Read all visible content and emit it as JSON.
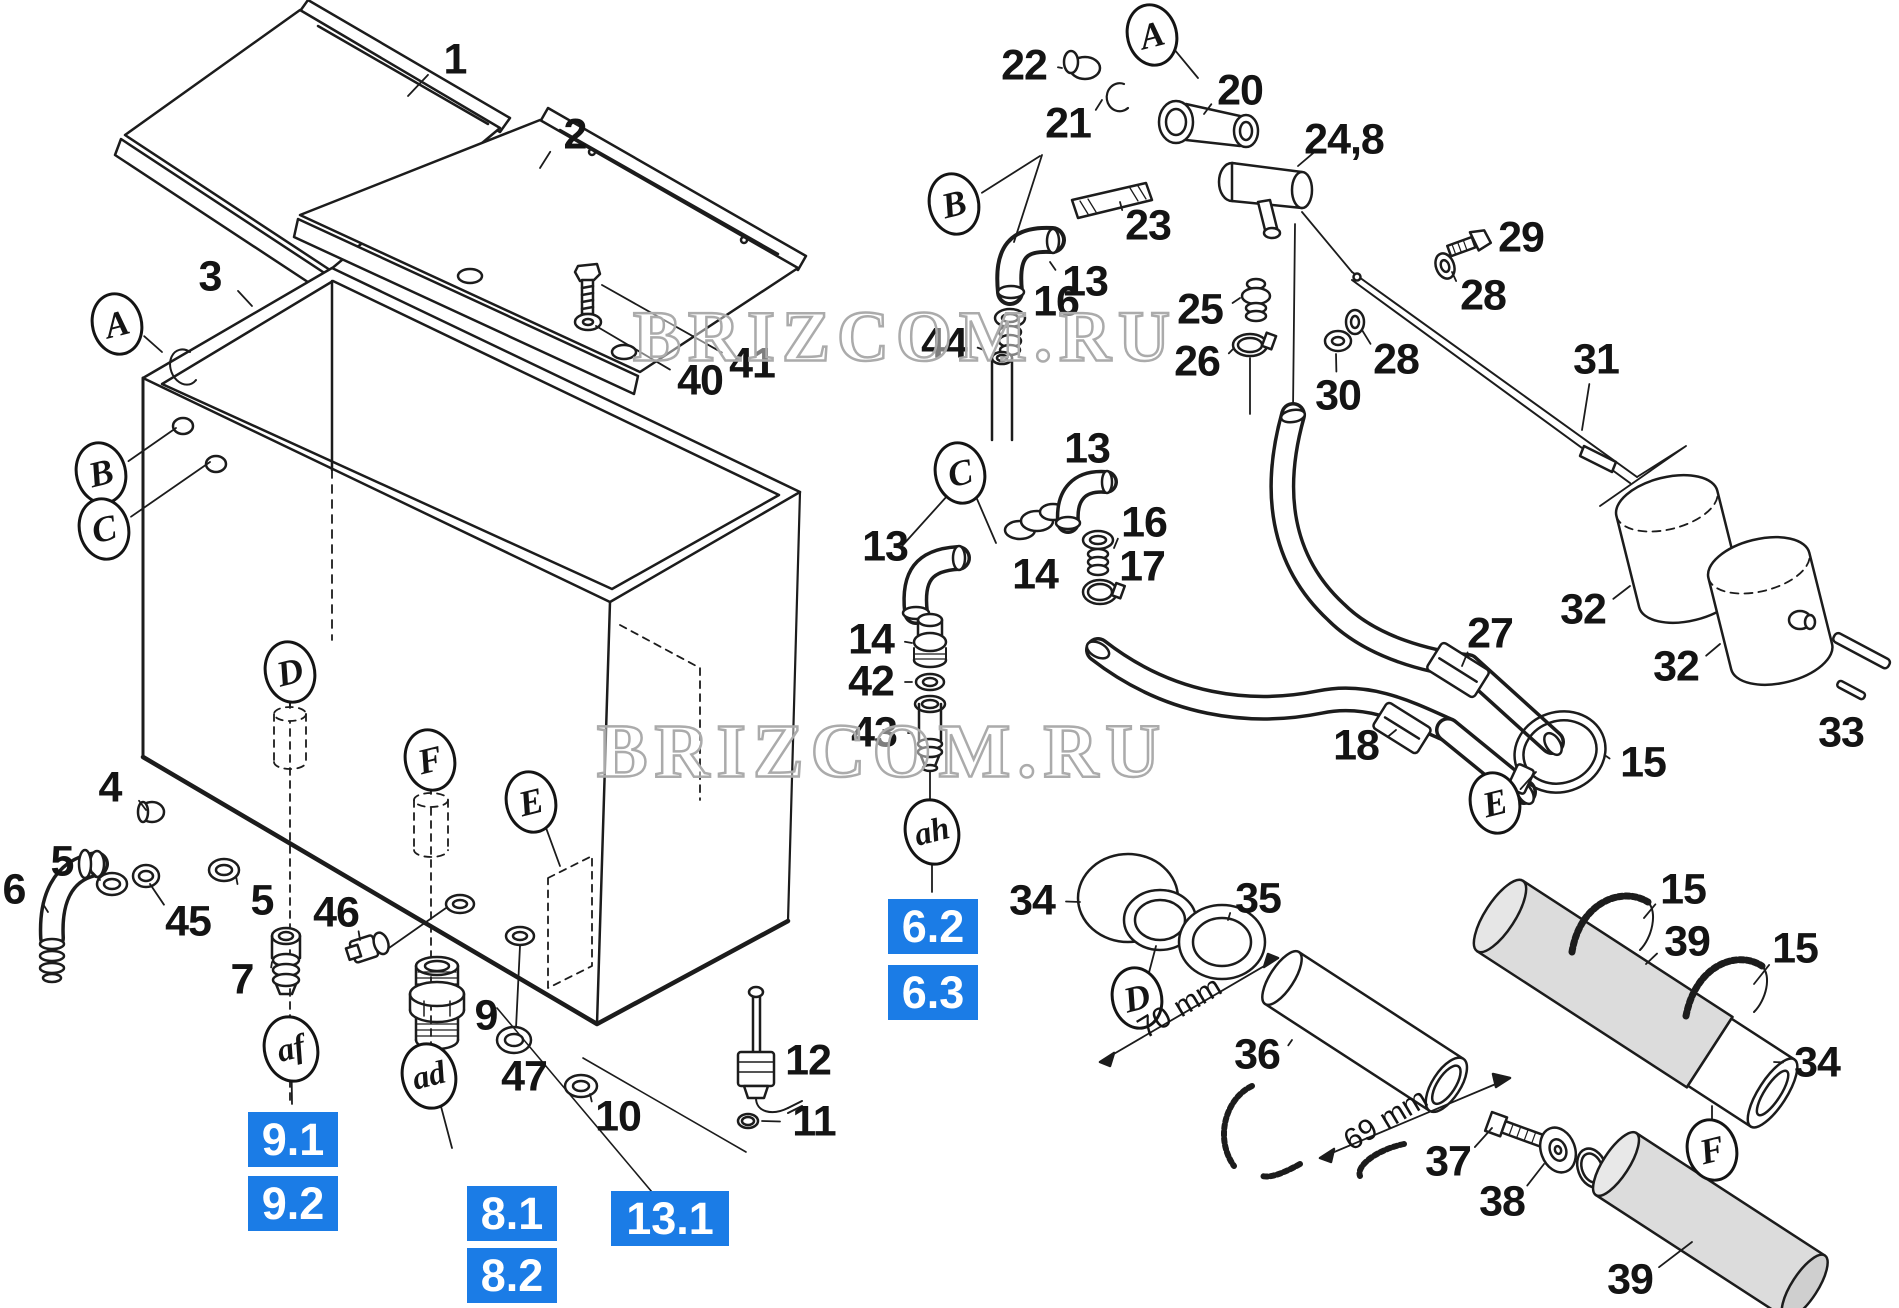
{
  "diagram": {
    "page_background": "#ffffff",
    "line_color": "#1c1c1c",
    "accent_blue": "#1b7ce6",
    "watermark_color": "#ababab",
    "watermarks": [
      {
        "text": "BRIZCOM.RU",
        "x": 905,
        "y": 337,
        "size": 72
      },
      {
        "text": "BRIZCOM.RU",
        "x": 882,
        "y": 752,
        "size": 76
      }
    ],
    "part_labels": [
      {
        "t": "1",
        "x": 455,
        "y": 60,
        "lx": 408,
        "ly": 96
      },
      {
        "t": "2",
        "x": 575,
        "y": 135,
        "lx": 540,
        "ly": 168
      },
      {
        "t": "3",
        "x": 210,
        "y": 277,
        "lx": 252,
        "ly": 306
      },
      {
        "t": "40",
        "x": 700,
        "y": 381,
        "lx": 596,
        "ly": 326
      },
      {
        "t": "41",
        "x": 752,
        "y": 364,
        "lx": 602,
        "ly": 285
      },
      {
        "t": "4",
        "x": 110,
        "y": 788,
        "lx": 146,
        "ly": 810
      },
      {
        "t": "5",
        "x": 62,
        "y": 862,
        "lx": 100,
        "ly": 880
      },
      {
        "t": "6",
        "x": 14,
        "y": 890,
        "lx": 48,
        "ly": 912
      },
      {
        "t": "45",
        "x": 188,
        "y": 922,
        "lx": 150,
        "ly": 884
      },
      {
        "t": "5",
        "x": 262,
        "y": 901,
        "lx": 236,
        "ly": 876
      },
      {
        "t": "46",
        "x": 336,
        "y": 913,
        "lx": 360,
        "ly": 940
      },
      {
        "t": "7",
        "x": 242,
        "y": 980,
        "lx": 272,
        "ly": 962
      },
      {
        "t": "9",
        "x": 486,
        "y": 1016,
        "lx": 460,
        "ly": 1002
      },
      {
        "t": "47",
        "x": 524,
        "y": 1077,
        "lx": 514,
        "ly": 1050
      },
      {
        "t": "10",
        "x": 618,
        "y": 1117,
        "lx": 590,
        "ly": 1094
      },
      {
        "t": "12",
        "x": 808,
        "y": 1061,
        "lx": 778,
        "ly": 1064
      },
      {
        "t": "11",
        "x": 814,
        "y": 1122,
        "lx": 762,
        "ly": 1121
      },
      {
        "t": "22",
        "x": 1024,
        "y": 66,
        "lx": 1062,
        "ly": 68
      },
      {
        "t": "21",
        "x": 1068,
        "y": 124,
        "lx": 1102,
        "ly": 100
      },
      {
        "t": "20",
        "x": 1240,
        "y": 91,
        "lx": 1204,
        "ly": 114
      },
      {
        "t": "23",
        "x": 1148,
        "y": 226,
        "lx": 1120,
        "ly": 202
      },
      {
        "t": "24,8",
        "x": 1344,
        "y": 140,
        "lx": 1298,
        "ly": 166
      },
      {
        "t": "13",
        "x": 1085,
        "y": 282,
        "lx": 1050,
        "ly": 262
      },
      {
        "t": "16",
        "x": 1056,
        "y": 302,
        "lx": 1028,
        "ly": 318
      },
      {
        "t": "44",
        "x": 944,
        "y": 344,
        "lx": 984,
        "ly": 350
      },
      {
        "t": "25",
        "x": 1200,
        "y": 310,
        "lx": 1240,
        "ly": 298
      },
      {
        "t": "26",
        "x": 1197,
        "y": 362,
        "lx": 1234,
        "ly": 348
      },
      {
        "t": "29",
        "x": 1521,
        "y": 238,
        "lx": 1490,
        "ly": 242
      },
      {
        "t": "28",
        "x": 1483,
        "y": 296,
        "lx": 1452,
        "ly": 272
      },
      {
        "t": "28",
        "x": 1396,
        "y": 360,
        "lx": 1362,
        "ly": 330
      },
      {
        "t": "30",
        "x": 1338,
        "y": 396,
        "lx": 1336,
        "ly": 354
      },
      {
        "t": "31",
        "x": 1596,
        "y": 360,
        "lx": 1582,
        "ly": 430
      },
      {
        "t": "13",
        "x": 885,
        "y": 547,
        "lx": 912,
        "ly": 566
      },
      {
        "t": "13",
        "x": 1087,
        "y": 449,
        "lx": 1082,
        "ly": 480
      },
      {
        "t": "14",
        "x": 1035,
        "y": 575,
        "lx": 1036,
        "ly": 544
      },
      {
        "t": "16",
        "x": 1144,
        "y": 523,
        "lx": 1114,
        "ly": 548
      },
      {
        "t": "17",
        "x": 1142,
        "y": 567,
        "lx": 1118,
        "ly": 590
      },
      {
        "t": "14",
        "x": 871,
        "y": 640,
        "lx": 912,
        "ly": 643
      },
      {
        "t": "42",
        "x": 871,
        "y": 682,
        "lx": 912,
        "ly": 682
      },
      {
        "t": "43",
        "x": 874,
        "y": 733,
        "lx": 912,
        "ly": 733
      },
      {
        "t": "27",
        "x": 1490,
        "y": 634,
        "lx": 1462,
        "ly": 666
      },
      {
        "t": "18",
        "x": 1356,
        "y": 746,
        "lx": 1396,
        "ly": 730
      },
      {
        "t": "32",
        "x": 1583,
        "y": 610,
        "lx": 1630,
        "ly": 586
      },
      {
        "t": "32",
        "x": 1676,
        "y": 667,
        "lx": 1720,
        "ly": 644
      },
      {
        "t": "33",
        "x": 1841,
        "y": 733,
        "lx": 1851,
        "ly": 702
      },
      {
        "t": "15",
        "x": 1643,
        "y": 763,
        "lx": 1606,
        "ly": 756
      },
      {
        "t": "34",
        "x": 1032,
        "y": 901,
        "lx": 1080,
        "ly": 902
      },
      {
        "t": "35",
        "x": 1258,
        "y": 899,
        "lx": 1228,
        "ly": 920
      },
      {
        "t": "36",
        "x": 1257,
        "y": 1055,
        "lx": 1292,
        "ly": 1040
      },
      {
        "t": "37",
        "x": 1448,
        "y": 1162,
        "lx": 1492,
        "ly": 1128
      },
      {
        "t": "38",
        "x": 1502,
        "y": 1202,
        "lx": 1544,
        "ly": 1164
      },
      {
        "t": "15",
        "x": 1683,
        "y": 890,
        "lx": 1644,
        "ly": 918
      },
      {
        "t": "39",
        "x": 1687,
        "y": 942,
        "lx": 1646,
        "ly": 964
      },
      {
        "t": "15",
        "x": 1795,
        "y": 949,
        "lx": 1754,
        "ly": 984
      },
      {
        "t": "34",
        "x": 1817,
        "y": 1063,
        "lx": 1774,
        "ly": 1062
      },
      {
        "t": "39",
        "x": 1630,
        "y": 1280,
        "lx": 1692,
        "ly": 1242
      }
    ],
    "callouts": [
      {
        "t": "A",
        "x": 117,
        "y": 324,
        "lx": 162,
        "ly": 352
      },
      {
        "t": "B",
        "x": 101,
        "y": 473,
        "lx": 176,
        "ly": 428
      },
      {
        "t": "C",
        "x": 104,
        "y": 529,
        "lx": 210,
        "ly": 462
      },
      {
        "t": "A",
        "x": 1152,
        "y": 35,
        "lx": 1198,
        "ly": 78
      },
      {
        "t": "B",
        "x": 954,
        "y": 204,
        "lx": 1040,
        "ly": 156
      },
      {
        "t": "C",
        "x": 960,
        "y": 473,
        "lx": 996,
        "ly": 543
      },
      {
        "t": "D",
        "x": 290,
        "y": 672,
        "lx": 290,
        "ly": 708
      },
      {
        "t": "F",
        "x": 430,
        "y": 760,
        "lx": 431,
        "ly": 794
      },
      {
        "t": "E",
        "x": 531,
        "y": 802,
        "lx": 560,
        "ly": 866
      },
      {
        "t": "D",
        "x": 1137,
        "y": 998,
        "lx": 1156,
        "ly": 946
      },
      {
        "t": "E",
        "x": 1495,
        "y": 803,
        "lx": 1536,
        "ly": 772
      },
      {
        "t": "F",
        "x": 1712,
        "y": 1150,
        "lx": 1712,
        "ly": 1106
      },
      {
        "t": "af",
        "x": 291,
        "y": 1049,
        "small": true,
        "lx": 292,
        "ly": 1104
      },
      {
        "t": "ad",
        "x": 429,
        "y": 1076,
        "small": true,
        "lx": 452,
        "ly": 1148
      },
      {
        "t": "ah",
        "x": 932,
        "y": 832,
        "small": true,
        "lx": 932,
        "ly": 892
      }
    ],
    "ref_boxes": [
      {
        "t": "9.1",
        "x": 248,
        "y": 1112,
        "w": 90,
        "h": 55
      },
      {
        "t": "9.2",
        "x": 248,
        "y": 1176,
        "w": 90,
        "h": 55
      },
      {
        "t": "8.1",
        "x": 467,
        "y": 1186,
        "w": 90,
        "h": 55
      },
      {
        "t": "8.2",
        "x": 467,
        "y": 1248,
        "w": 90,
        "h": 55
      },
      {
        "t": "13.1",
        "x": 611,
        "y": 1191,
        "w": 118,
        "h": 55
      },
      {
        "t": "6.2",
        "x": 888,
        "y": 899,
        "w": 90,
        "h": 55
      },
      {
        "t": "6.3",
        "x": 888,
        "y": 965,
        "w": 90,
        "h": 55
      }
    ],
    "dimensions": [
      {
        "t": "70 mm",
        "x": 1180,
        "y": 1008,
        "rot": -31
      },
      {
        "t": "69 mm",
        "x": 1386,
        "y": 1120,
        "rot": -31
      }
    ]
  }
}
